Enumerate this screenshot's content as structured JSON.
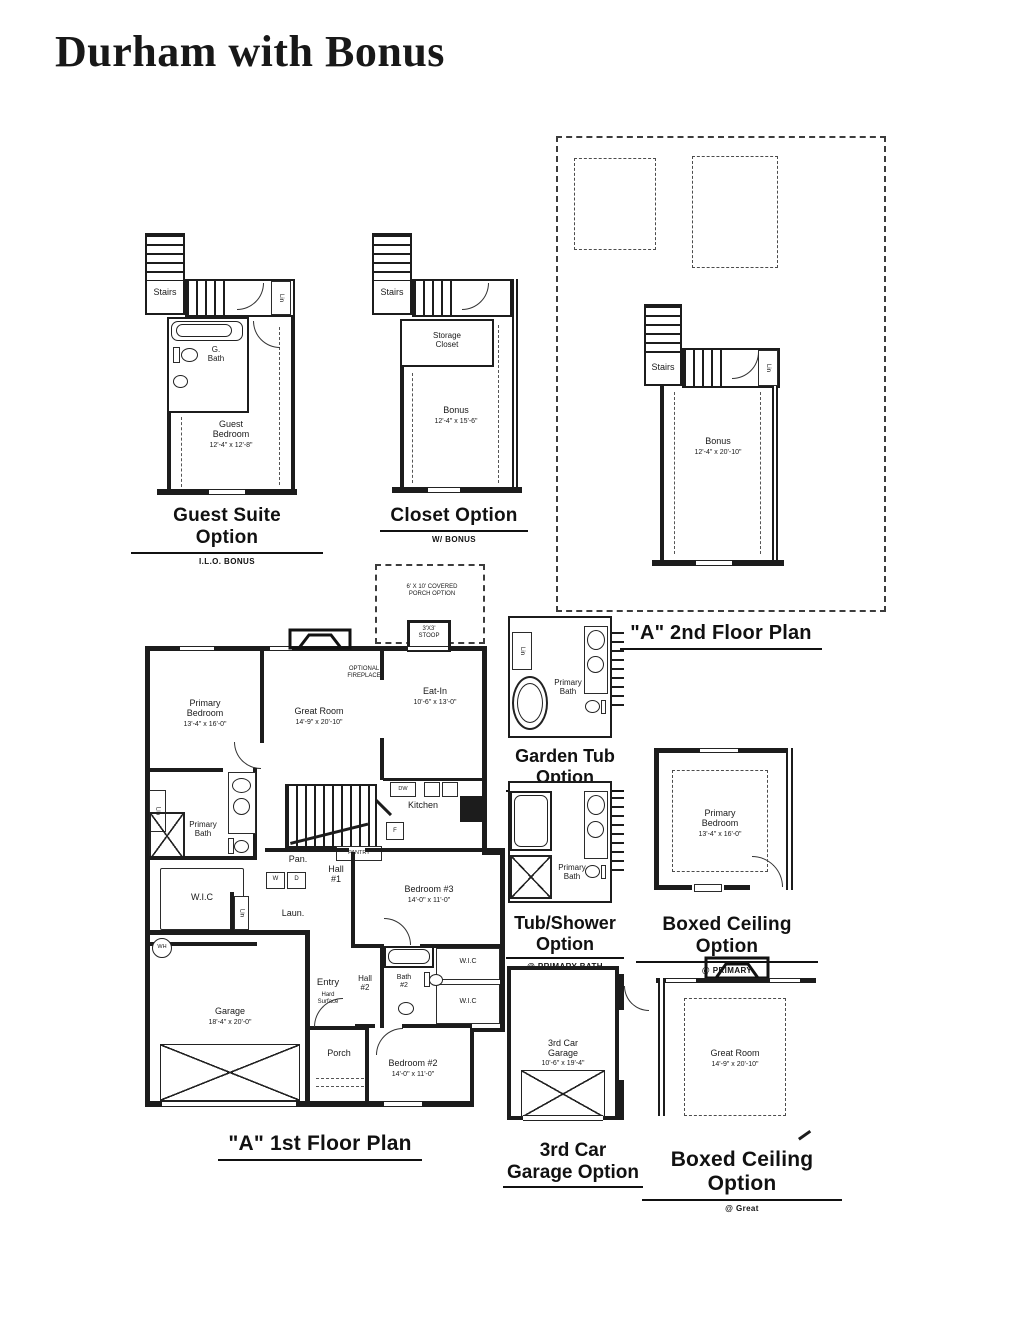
{
  "page": {
    "title": "Durham with Bonus"
  },
  "guest_suite": {
    "stairs_label": "Stairs",
    "lin_label": "Lin",
    "bath_label": "G.\nBath",
    "room_name": "Guest\nBedroom",
    "room_dims": "12'-4\" x 12'-8\"",
    "title": "Guest Suite Option",
    "subtitle": "I.L.O. BONUS"
  },
  "closet_option": {
    "stairs_label": "Stairs",
    "storage_label": "Storage\nCloset",
    "room_name": "Bonus",
    "room_dims": "12'-4\" x 15'-6\"",
    "title": "Closet Option",
    "subtitle": "W/ BONUS"
  },
  "second_floor": {
    "stairs_label": "Stairs",
    "lin_label": "Lin",
    "room_name": "Bonus",
    "room_dims": "12'-4\" x 20'-10\"",
    "title": "\"A\" 2nd Floor Plan"
  },
  "first_floor": {
    "porch_note": "6' X 10' COVERED\nPORCH OPTION",
    "stoop_label": "3'X3'\nSTOOP",
    "fireplace_note": "OPTIONAL\nFIREPLACE",
    "primary_bedroom": {
      "name": "Primary\nBedroom",
      "dims": "13'-4\" x 16'-0\""
    },
    "great_room": {
      "name": "Great Room",
      "dims": "14'-9\" x 20'-10\""
    },
    "eat_in": {
      "name": "Eat-In",
      "dims": "10'-6\" x 13'-0\""
    },
    "kitchen_label": "Kitchen",
    "dw_label": "DW",
    "fridge_label": "F",
    "washer_label": "W",
    "dryer_label": "D",
    "water_heater_label": "WH",
    "pantry_label": "Pan.",
    "pantry_shelf_label": "PANTRY",
    "lin_label": "Lin",
    "lin2_label": "Lin",
    "primary_bath_label": "Primary\nBath",
    "wic_label": "W.I.C",
    "wic2_label": "W.I.C",
    "wic3_label": "W.I.C",
    "hall1_label": "Hall\n#1",
    "hall2_label": "Hall\n#2",
    "laundry_label": "Laun.",
    "bath2_label": "Bath\n#2",
    "entry_label": "Entry",
    "entry_sub_label": "Hard\nSurface",
    "bedroom3": {
      "name": "Bedroom #3",
      "dims": "14'-0\" x 11'-0\""
    },
    "bedroom2": {
      "name": "Bedroom #2",
      "dims": "14'-0\" x 11'-0\""
    },
    "garage": {
      "name": "Garage",
      "dims": "18'-4\" x 20'-0\""
    },
    "porch_label": "Porch",
    "title": "\"A\" 1st Floor Plan"
  },
  "garden_tub": {
    "lin_label": "Lin",
    "bath_label": "Primary\nBath",
    "title_line1": "Garden Tub",
    "title_line2": "Option",
    "subtitle": "@ PRIMARY BATH"
  },
  "tub_shower": {
    "bath_label": "Primary\nBath",
    "title_line1": "Tub/Shower",
    "title_line2": "Option",
    "subtitle": "@ PRIMARY BATH"
  },
  "boxed_primary": {
    "room_name": "Primary\nBedroom",
    "room_dims": "13'-4\" x 16'-0\"",
    "title": "Boxed Ceiling Option",
    "subtitle": "@ PRIMARY"
  },
  "third_car": {
    "room_name": "3rd Car\nGarage",
    "room_dims": "10'-6\" x 19'-4\"",
    "title_line1": "3rd Car",
    "title_line2": "Garage Option"
  },
  "boxed_great": {
    "room_name": "Great Room",
    "room_dims": "14'-9\" x 20'-10\"",
    "title": "Boxed Ceiling Option",
    "subtitle": "@ Great"
  }
}
